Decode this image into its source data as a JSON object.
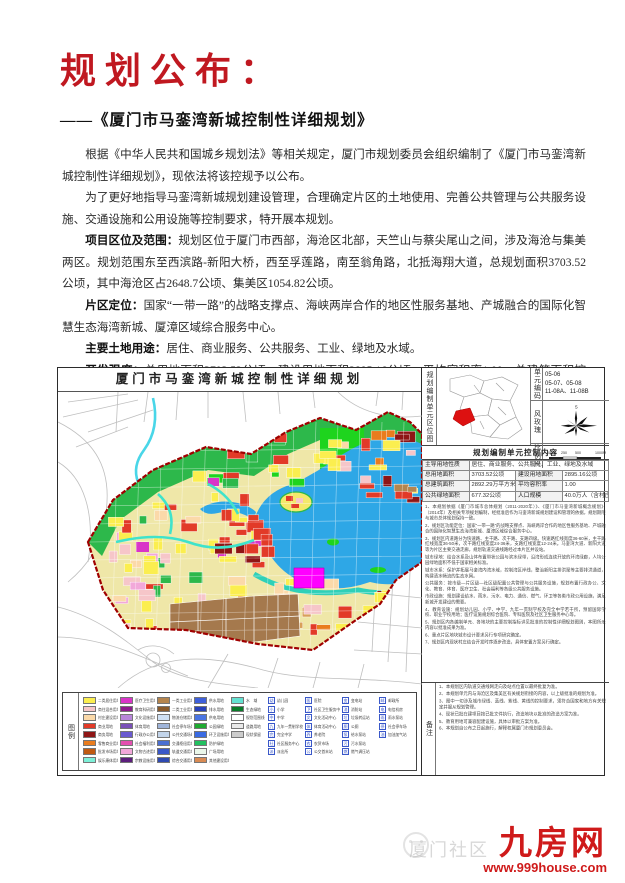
{
  "page": {
    "title": "规划公布：",
    "subtitle": "——《厦门市马銮湾新城控制性详细规划》",
    "paragraphs": [
      {
        "lead": "",
        "text": "根据《中华人民共和国城乡规划法》等相关规定，厦门市规划委员会组织编制了《厦门市马銮湾新城控制性详细规划》，现依法将该控规予以公布。"
      },
      {
        "lead": "",
        "text": "为了更好地指导马銮湾新城规划建设管理，合理确定片区的土地使用、完善公共管理与公共服务设施、交通设施和公用设施等控制要求，特开展本规划。"
      },
      {
        "lead": "项目区位及范围：",
        "text": "规划区位于厦门市西部，海沧区北部，天竺山与蔡尖尾山之间，涉及海沧与集美两区。规划范围东至西滨路-新阳大桥，西至孚莲路，南至翁角路，北抵海翔大道，总规划面积3703.52公顷，其中海沧区占2648.7公顷、集美区1054.82公顷。"
      },
      {
        "lead": "片区定位：",
        "text": "国家“一带一路”的战略支撑点、海峡两岸合作的地区性服务基地、产城融合的国际化智慧生态海湾新城、厦漳区域综合服务中心。"
      },
      {
        "lead": "主要土地用途：",
        "text": "居住、商业服务、公共服务、工业、绿地及水域。"
      },
      {
        "lead": "开发强度：",
        "text": "总用地面积3703.52公顷，建设用地面积2895.16公顷，平均容积率1.00，总建筑面积控制在2892.29万平方米，规划常住人口规模40.0万人（含村庄人口4万人）。"
      }
    ],
    "signature": {
      "owner": "项目负责人：洪志超",
      "phone": "联系电话：5090342"
    }
  },
  "map": {
    "title": "厦门市马銮湾新城控制性详细规划",
    "location_panel": {
      "side_label": "规划编制单元区位图",
      "unit_code_label": "单元编码",
      "unit_codes": [
        "05-06",
        "05-07、05-08",
        "11-08A、11-08B"
      ],
      "wind_label": "风玫瑰",
      "wind_n": "5",
      "scale_label": "比例尺",
      "scale_ticks": [
        "0",
        "250",
        "500",
        "1000M"
      ]
    },
    "control_table": {
      "title": "规划编制单元控制内容",
      "rows": [
        [
          "主导用地性质",
          "居住、商业服务、公共服务、工业、绿地及水域"
        ],
        [
          "总用地面积",
          "3703.52公顷",
          "建设用地面积",
          "2895.16公顷"
        ],
        [
          "总建筑面积",
          "2892.29万平方米",
          "平均容积率",
          "1.00"
        ],
        [
          "公共绿地面积",
          "677.32公顷",
          "人口规模",
          "40.0万人（含村庄人口4万人）"
        ]
      ]
    },
    "notes": [
      "1、本规划依据《厦门市城市总体规划（2011-2020年）》、《厦门市马銮湾新城概念规划》（2014年）及相关专项规划编制，经批准后作为马銮湾新城规划建设和管理的依据，规划期限与城市总体规划保持一致。",
      "2、规划区功能定位：国家“一带一路”的战略支撑点、海峡两岸合作的地区性服务基地、产城融合的国际化智慧生态海湾新城、厦漳区域综合服务中心。",
      "3、规划区内道路分为快速路、主干路、次干路、支路四级。快速路红线宽度36-60米，主干路红线宽度36-50米，次干路红线宽度24-36米，支路红线宽度12-24米。马銮湾大道、新阳大道等为片区主要交通走廊，规划轨道交通线路经过本片区并设站。",
      "城市绿地：结合水系及山体布置带状公园与滨水绿带，沿湾形成连续开放的环湾绿廊，人均公园绿地面积不低于国家相关标准。",
      "城市水系：保护并拓展马銮湾内湾水域，控制湾区岸线，整治新阳主排洪渠等主要排洪通道，构建清水畅流的生态水网。",
      "公共服务：按市级—片区级—社区级配置公共管理与公共服务设施，规划布置行政办公、文化、教育、体育、医疗卫生、社会福利等各级公共服务设施。",
      "市政设施：规划建设给水、雨水、污水、电力、通信、燃气、环卫等各类市政公用设施，满足新城开发建设的需要。",
      "4、教育设施：规划幼儿园、小学、中学、九年一贯制学校及完全中学若干所，预留国际学校、职业学校用地；医疗设施规划综合医院、专科医院及社区卫生服务中心等。",
      "5、规划区内各编制单元、各地块的主要控制指标详见批准的控制性详细规划图则，本图所示内容以批准成果为准。",
      "6、重点片区地块城市设计要求另行专项研究确定。",
      "7、规划区内现状村庄结合开发时序逐步改造，具体安置方案另行确定。"
    ],
    "remarks": {
      "side_label": "备注",
      "lines": [
        "1、本规划区内轨道交通线网走向及站点位置以最终批复为准。",
        "2、本规划单元内与海沧区及集美区有关规划衔接的内容，以上级批准的规划为准。",
        "3、图中一切涉及城市绿线、蓝线、紫线、黄线的控制要求，须符合国家和地方有关规定并服从规划管理。",
        "4、现状已批在建项目按已批文件执行，改造地块以批准的改造方案为准。",
        "5、教育用地可兼容配建设施，具体以审批方案为准。",
        "6、本规划自公布之日起施行，解释权属厦门市规划委员会。"
      ]
    },
    "legend": {
      "side_label": "图例",
      "columns": [
        {
          "type": "color",
          "items": [
            {
              "c": "#fbee4f",
              "label": "二类居住用地"
            },
            {
              "c": "#f6c6c9",
              "label": "商住混合用地"
            },
            {
              "c": "#fbd9a9",
              "label": "村庄建设用地"
            },
            {
              "c": "#e23a28",
              "label": "商业用地"
            },
            {
              "c": "#8e1515",
              "label": "商务用地"
            },
            {
              "c": "#e97c1e",
              "label": "零售商业用地"
            },
            {
              "c": "#c05a12",
              "label": "批发市场用地"
            },
            {
              "c": "#7df0d8",
              "label": "娱乐康体用地"
            }
          ]
        },
        {
          "type": "color",
          "items": [
            {
              "c": "#d935c8",
              "label": "医疗卫生用地"
            },
            {
              "c": "#8d1b8d",
              "label": "教育科研用地"
            },
            {
              "c": "#b886da",
              "label": "文化设施用地"
            },
            {
              "c": "#7a50b8",
              "label": "体育用地"
            },
            {
              "c": "#6a5ad0",
              "label": "行政办公用地"
            },
            {
              "c": "#e24fb0",
              "label": "社会福利用地"
            },
            {
              "c": "#f2a8da",
              "label": "文物古迹用地"
            },
            {
              "c": "#5c1e7c",
              "label": "宗教设施用地"
            }
          ]
        },
        {
          "type": "color",
          "items": [
            {
              "c": "#b5854e",
              "label": "一类工业用地"
            },
            {
              "c": "#8a5a2b",
              "label": "二类工业用地"
            },
            {
              "c": "#cfe0f3",
              "label": "物流仓储用地"
            },
            {
              "c": "#9fb4d9",
              "label": "社会停车场用地"
            },
            {
              "c": "#c2d4ea",
              "label": "公共交通场站用地"
            },
            {
              "c": "#4a6fd2",
              "label": "交通枢纽用地"
            },
            {
              "c": "#3a58c9",
              "label": "轨道交通用地"
            },
            {
              "c": "#2f4ab2",
              "label": "综合交通用地"
            }
          ]
        },
        {
          "type": "color",
          "items": [
            {
              "c": "#3f60da",
              "label": "供水用地"
            },
            {
              "c": "#2841ba",
              "label": "排水用地"
            },
            {
              "c": "#4a75e2",
              "label": "供电用地"
            },
            {
              "c": "#1faa31",
              "label": "公园绿地"
            },
            {
              "c": "#3a6be2",
              "label": "环卫设施用地"
            },
            {
              "c": "#22c161",
              "label": "防护绿地"
            },
            {
              "c": "#eaf7ea",
              "label": "广场用地"
            },
            {
              "c": "#d98b53",
              "label": "其他建设用地"
            }
          ]
        },
        {
          "type": "color",
          "items": [
            {
              "c": "#64e1d1",
              "label": "水　域"
            },
            {
              "c": "#0a7b29",
              "label": "生态绿地"
            },
            {
              "c": "#ffffff",
              "label": "规划范围线"
            },
            {
              "c": "#e9e9e9",
              "label": "道路用地"
            },
            {
              "c": "#cccccc",
              "label": "现状保留"
            }
          ]
        },
        {
          "type": "symbol",
          "items": [
            {
              "k": "幼",
              "label": "幼儿园"
            },
            {
              "k": "小",
              "label": "小学"
            },
            {
              "k": "中",
              "label": "中学"
            },
            {
              "k": "九",
              "label": "九年一贯制学校"
            },
            {
              "k": "完",
              "label": "完全中学"
            },
            {
              "k": "社",
              "label": "社区服务中心"
            },
            {
              "k": "派",
              "label": "派出所"
            }
          ]
        },
        {
          "type": "symbol",
          "items": [
            {
              "k": "医",
              "label": "医院"
            },
            {
              "k": "卫",
              "label": "社区卫生服务中心"
            },
            {
              "k": "文",
              "label": "文化活动中心"
            },
            {
              "k": "体",
              "label": "体育活动中心"
            },
            {
              "k": "养",
              "label": "养老院"
            },
            {
              "k": "农",
              "label": "农贸市场"
            },
            {
              "k": "公",
              "label": "公交首末站"
            }
          ]
        },
        {
          "type": "symbol",
          "items": [
            {
              "k": "变",
              "label": "变电站"
            },
            {
              "k": "消",
              "label": "消防站"
            },
            {
              "k": "垃",
              "label": "垃圾转运站"
            },
            {
              "k": "厕",
              "label": "公厕"
            },
            {
              "k": "泵",
              "label": "给水泵站"
            },
            {
              "k": "污",
              "label": "污水泵站"
            },
            {
              "k": "燃",
              "label": "燃气调压站"
            }
          ]
        },
        {
          "type": "symbol",
          "items": [
            {
              "k": "邮",
              "label": "邮政所"
            },
            {
              "k": "电",
              "label": "电信机房"
            },
            {
              "k": "雨",
              "label": "雨水泵站"
            },
            {
              "k": "停",
              "label": "社会停车场"
            },
            {
              "k": "油",
              "label": "加油加气站"
            }
          ]
        }
      ]
    }
  },
  "watermark": {
    "brand": "九房网",
    "url": "www.999house.com",
    "ghost": "厦门社区"
  }
}
